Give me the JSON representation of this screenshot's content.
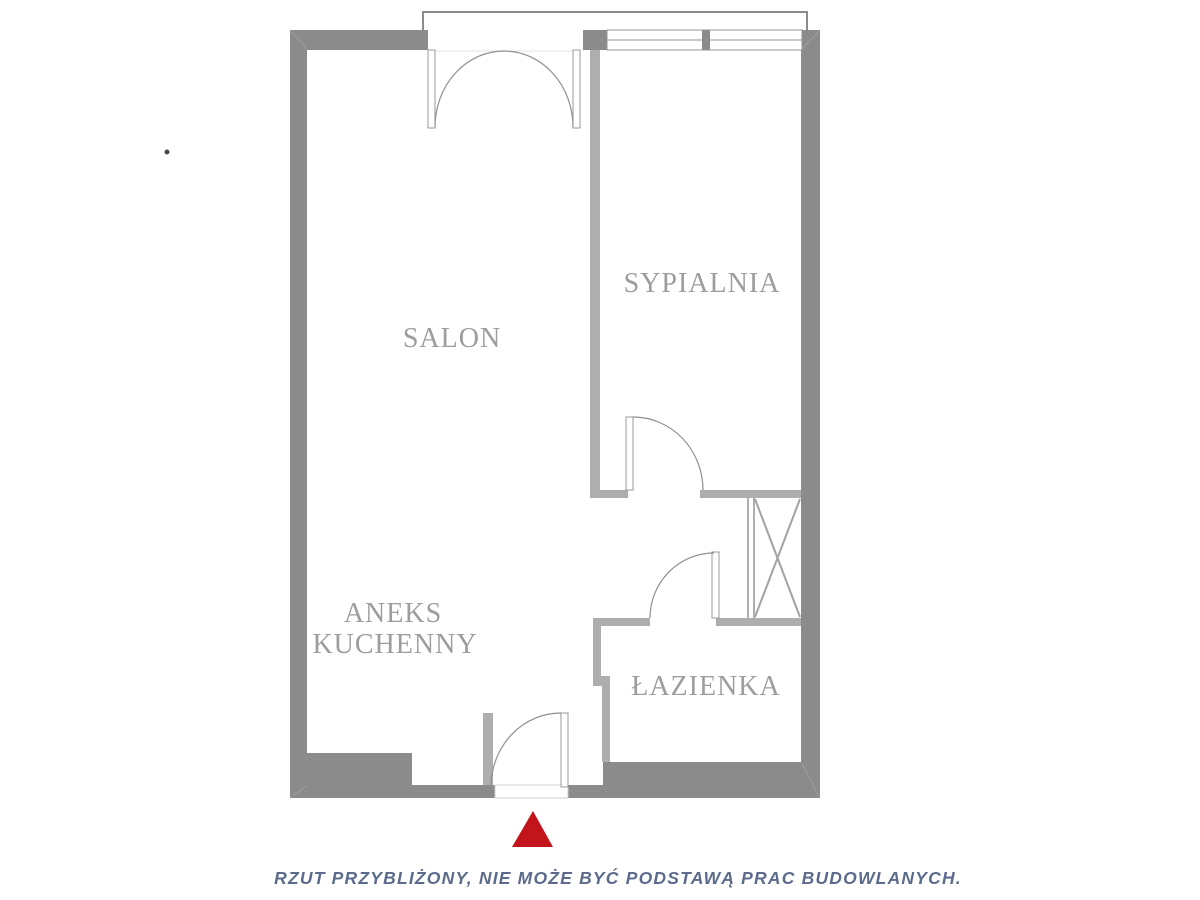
{
  "rooms": {
    "salon": {
      "label": "SALON"
    },
    "sypialnia": {
      "label": "SYPIALNIA"
    },
    "kitchen": {
      "line1": "ANEKS",
      "line2": "KUCHENNY"
    },
    "bathroom": {
      "label": "ŁAZIENKA"
    }
  },
  "disclaimer": "RZUT PRZYBLIŻONY, NIE MOŻE BYĆ PODSTAWĄ PRAC BUDOWLANYCH.",
  "marker": {
    "shape": "triangle-up",
    "color": "#c1151b"
  },
  "colors": {
    "wall_dark": "#8b8b8b",
    "wall_light": "#aeaeae",
    "line": "#969696",
    "label_text": "#9d9d9d",
    "disclaimer_text": "#5c6b8c",
    "accent": "#c1151b",
    "background": "#ffffff"
  }
}
